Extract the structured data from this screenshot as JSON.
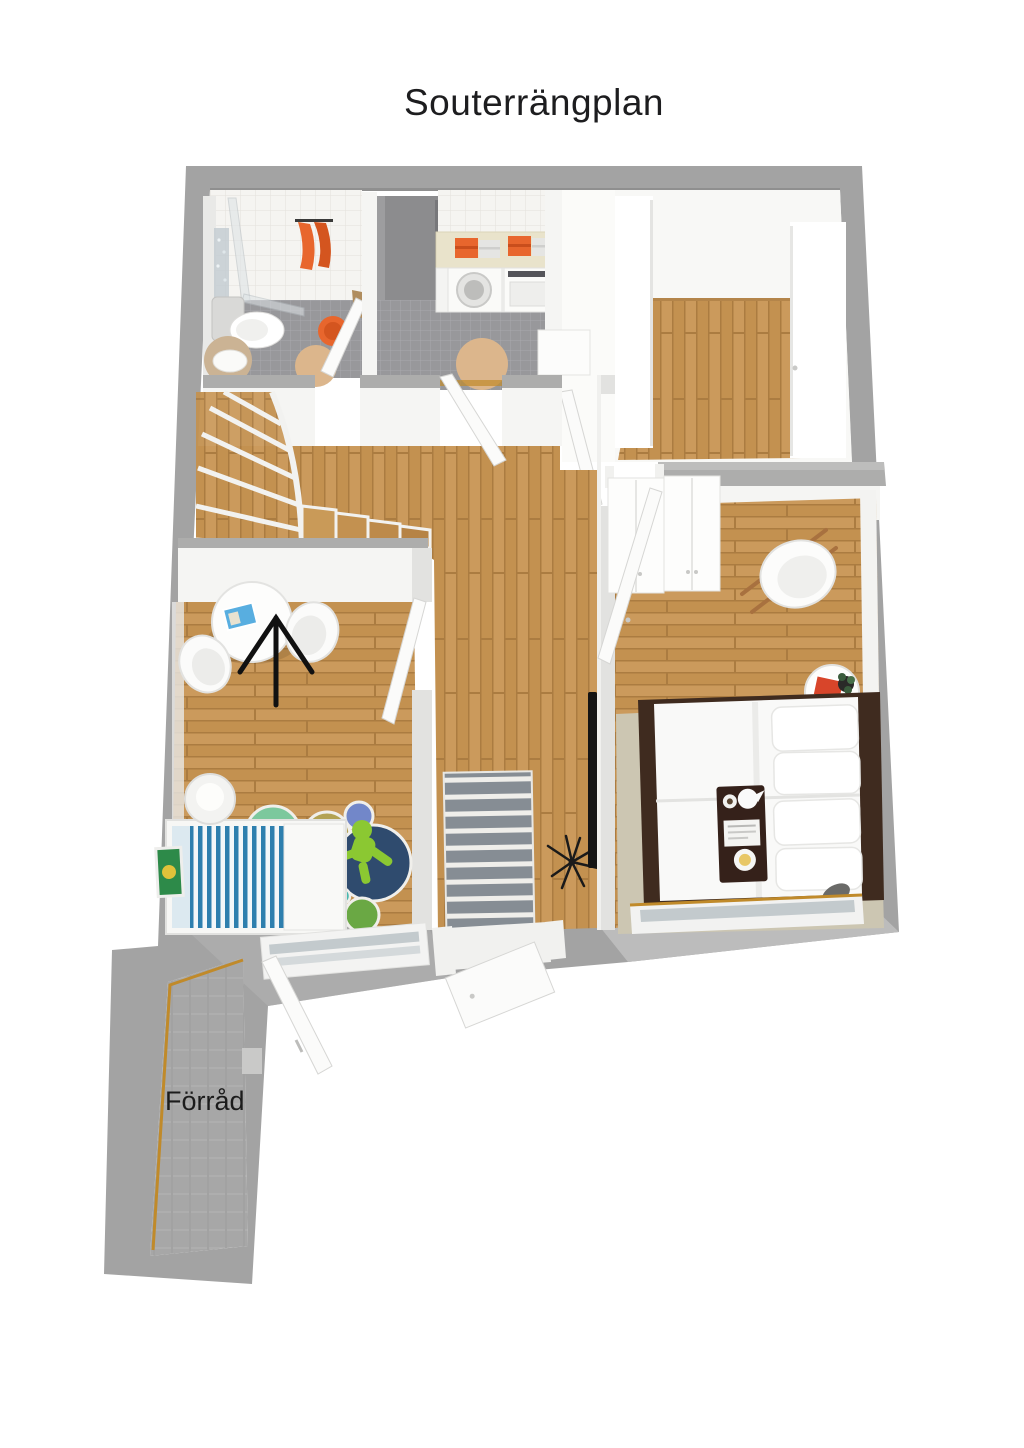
{
  "title": "Souterrängplan",
  "labels": {
    "storage": "Förråd"
  },
  "colors": {
    "background": "#ffffff",
    "text": "#1d1d1f",
    "wall-gray": "#a3a3a3",
    "wood": "#c39150",
    "wood-light": "#cb9a5c",
    "wood-dark": "#ab7c41",
    "tile-gray": "#98989b",
    "tile-white": "#f5f4f1",
    "concrete": "#a7a7a7",
    "accent-orange": "#e8662d",
    "counter-beige": "#e9e3cb",
    "stool-beige": "#dcb68c",
    "dark-wood": "#3f2b1f",
    "rug-beige": "#ccc6b2",
    "rug-stripe-gray": "#868d94",
    "kids-navy": "#2f4b6e",
    "kids-mint": "#7cc89d",
    "kids-olive": "#b3a253",
    "kids-blue": "#7287c9",
    "kids-teal": "#49b8b0",
    "toy-green": "#8bc832",
    "bed-stripe-blue": "#2e7fae",
    "glass-gray": "#c3cacd",
    "threshold-orange": "#c08a2a"
  }
}
